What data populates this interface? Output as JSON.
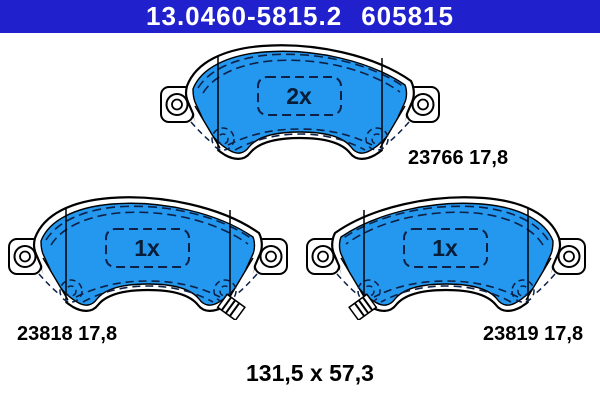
{
  "header": {
    "part_number": "13.0460-5815.2",
    "oe_number": "605815",
    "background_color": "#2020cd",
    "text_color": "#ffffff"
  },
  "colors": {
    "pad_fill": "#2497ee",
    "outline": "#000000",
    "detail_lines": "#0d2147",
    "quantity_text": "#071c36",
    "page_background": "#ffffff"
  },
  "pads": [
    {
      "id": "upper",
      "wva_number": "23766",
      "thickness_mm": "17,8",
      "label_text": "23766 17,8",
      "quantity_label": "2x",
      "wear_indicator": false,
      "mirrored": false
    },
    {
      "id": "lower-left",
      "wva_number": "23818",
      "thickness_mm": "17,8",
      "label_text": "23818 17,8",
      "quantity_label": "1x",
      "wear_indicator": true,
      "mirrored": false
    },
    {
      "id": "lower-right",
      "wva_number": "23819",
      "thickness_mm": "17,8",
      "label_text": "23819 17,8",
      "quantity_label": "1x",
      "wear_indicator": true,
      "mirrored": true
    }
  ],
  "footer": {
    "dimensions_label": "131,5 x 57,3"
  }
}
